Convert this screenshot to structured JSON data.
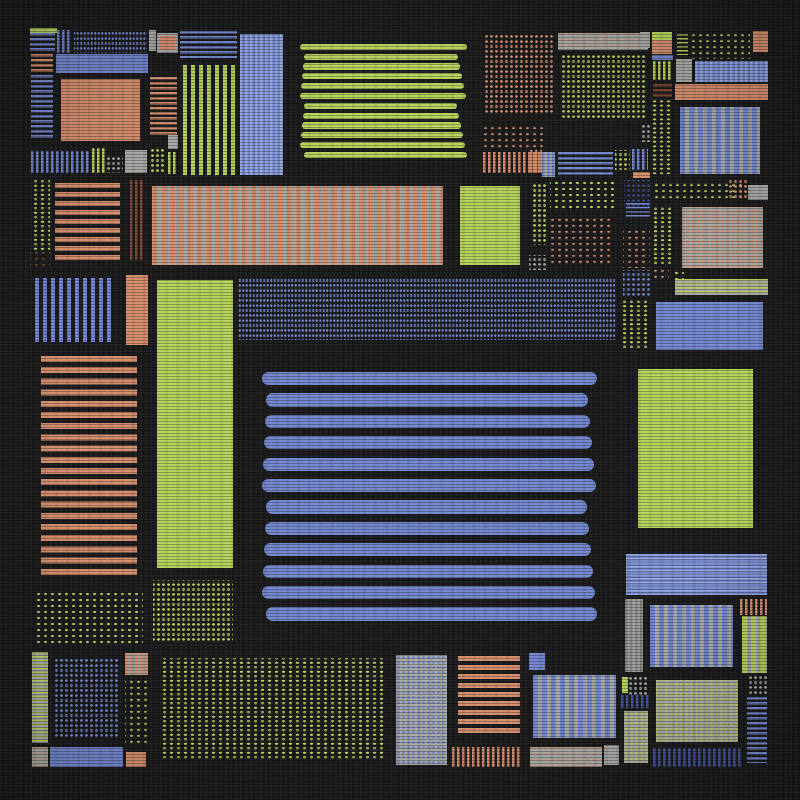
{
  "artwork": {
    "description": "abstract patchwork quilt composition on dark fabric",
    "canvas": {
      "width": 800,
      "height": 800,
      "background": "#1c1c1d"
    }
  },
  "palette": {
    "blue": "#7488d0",
    "blueLight": "#97a7e0",
    "blueDark": "#46559c",
    "navy": "#3d4c88",
    "orange": "#d68e6d",
    "rust": "#7e4531",
    "green": "#b7d35c",
    "gray": "#a9a9a6",
    "grayDark": "#83837f",
    "background": "#1c1c1d"
  },
  "patterns": {
    "solid": {
      "type": "solid"
    },
    "bars": {
      "type": "bars"
    },
    "hs2": {
      "type": "stripes",
      "angle": 180,
      "t": 1.5,
      "per": 4
    },
    "hs3": {
      "type": "stripes",
      "angle": 180,
      "t": 2.5,
      "per": 5
    },
    "hs5": {
      "type": "stripes",
      "angle": 180,
      "t": 5,
      "per": 9
    },
    "hs6": {
      "type": "stripes",
      "angle": 180,
      "t": 6,
      "per": 11.2
    },
    "vs2": {
      "type": "stripes",
      "angle": 90,
      "t": 2.5,
      "per": 5
    },
    "vs4": {
      "type": "stripes",
      "angle": 90,
      "t": 4,
      "per": 8
    },
    "vs5on": {
      "type": "stripes",
      "angle": 90,
      "t": 5,
      "per": 9
    },
    "dots4": {
      "type": "dots",
      "r": 0.9,
      "sx": 3.5,
      "sy": 5
    },
    "dots5": {
      "type": "dots",
      "r": 1.2,
      "sx": 5,
      "sy": 5
    },
    "dots7": {
      "type": "dots",
      "r": 1.2,
      "sx": 7,
      "sy": 6
    },
    "dcol": {
      "type": "dots",
      "r": 1.5,
      "sx": 7,
      "sy": 4.5
    }
  },
  "rects": [
    {
      "x": 30,
      "y": 28,
      "w": 27,
      "h": 5,
      "c": "green",
      "p": "solid"
    },
    {
      "x": 30,
      "y": 33,
      "w": 25,
      "h": 20,
      "c": "blue",
      "p": "hs3"
    },
    {
      "x": 57,
      "y": 30,
      "w": 15,
      "h": 23,
      "c": "blue",
      "p": "vs2"
    },
    {
      "x": 74,
      "y": 30,
      "w": 73,
      "h": 23,
      "c": "blue",
      "p": "dots4"
    },
    {
      "x": 149,
      "y": 30,
      "w": 7,
      "h": 21,
      "c": "gray",
      "p": "solid"
    },
    {
      "x": 157,
      "y": 33,
      "w": 21,
      "h": 20,
      "c": "gray",
      "p": "solid"
    },
    {
      "x": 160,
      "y": 36,
      "w": 15,
      "h": 14,
      "c": "orange",
      "p": "solid"
    },
    {
      "x": 31,
      "y": 54,
      "w": 22,
      "h": 18,
      "c": "orange",
      "p": "hs3"
    },
    {
      "x": 56,
      "y": 54,
      "w": 92,
      "h": 19,
      "c": "blue",
      "p": "solid"
    },
    {
      "x": 180,
      "y": 31,
      "w": 57,
      "h": 27,
      "c": "blue",
      "p": "hs3"
    },
    {
      "x": 240,
      "y": 34,
      "w": 43,
      "h": 141,
      "c": "blueLight",
      "b": "blue",
      "p": "vs2"
    },
    {
      "x": 31,
      "y": 75,
      "w": 22,
      "h": 65,
      "c": "blue",
      "p": "hs3"
    },
    {
      "x": 61,
      "y": 79,
      "w": 79,
      "h": 62,
      "c": "orange",
      "p": "solid"
    },
    {
      "x": 150,
      "y": 77,
      "w": 27,
      "h": 58,
      "c": "orange",
      "p": "hs3"
    },
    {
      "x": 183,
      "y": 65,
      "w": 52,
      "h": 110,
      "c": "green",
      "p": "vs4"
    },
    {
      "x": 168,
      "y": 135,
      "w": 10,
      "h": 14,
      "c": "gray",
      "p": "solid"
    },
    {
      "x": 31,
      "y": 151,
      "w": 59,
      "h": 22,
      "c": "blue",
      "p": "vs2"
    },
    {
      "x": 92,
      "y": 148,
      "w": 13,
      "h": 25,
      "c": "green",
      "p": "vs2"
    },
    {
      "x": 107,
      "y": 155,
      "w": 16,
      "h": 18,
      "c": "gray",
      "p": "dots5"
    },
    {
      "x": 125,
      "y": 150,
      "w": 22,
      "h": 23,
      "c": "gray",
      "p": "solid"
    },
    {
      "x": 150,
      "y": 148,
      "w": 15,
      "h": 25,
      "c": "green",
      "p": "dots5"
    },
    {
      "x": 168,
      "y": 152,
      "w": 10,
      "h": 22,
      "c": "green",
      "p": "vs2"
    },
    {
      "x": 300,
      "y": 42,
      "w": 168,
      "h": 118,
      "c": "green",
      "p": "bars",
      "n": 12
    },
    {
      "x": 485,
      "y": 33,
      "w": 70,
      "h": 82,
      "c": "orange",
      "p": "dots5"
    },
    {
      "x": 480,
      "y": 125,
      "w": 65,
      "h": 24,
      "c": "orange",
      "p": "dots7"
    },
    {
      "x": 483,
      "y": 152,
      "w": 57,
      "h": 21,
      "c": "orange",
      "p": "vs2"
    },
    {
      "x": 558,
      "y": 33,
      "w": 90,
      "h": 17,
      "c": "orange",
      "b": "gray",
      "p": "dots7"
    },
    {
      "x": 560,
      "y": 55,
      "w": 85,
      "h": 65,
      "c": "green",
      "p": "dots5"
    },
    {
      "x": 640,
      "y": 32,
      "w": 10,
      "h": 16,
      "c": "gray",
      "p": "solid"
    },
    {
      "x": 652,
      "y": 32,
      "w": 20,
      "h": 8,
      "c": "green",
      "p": "solid"
    },
    {
      "x": 652,
      "y": 40,
      "w": 20,
      "h": 14,
      "c": "orange",
      "p": "solid"
    },
    {
      "x": 652,
      "y": 55,
      "w": 21,
      "h": 5,
      "c": "blue",
      "p": "solid"
    },
    {
      "x": 653,
      "y": 61,
      "w": 19,
      "h": 19,
      "c": "green",
      "p": "vs2"
    },
    {
      "x": 653,
      "y": 84,
      "w": 19,
      "h": 15,
      "c": "rust",
      "p": "hs3"
    },
    {
      "x": 677,
      "y": 34,
      "w": 11,
      "h": 21,
      "c": "green",
      "p": "hs2"
    },
    {
      "x": 690,
      "y": 34,
      "w": 60,
      "h": 25,
      "c": "green",
      "p": "dots7"
    },
    {
      "x": 753,
      "y": 31,
      "w": 15,
      "h": 21,
      "c": "orange",
      "p": "solid"
    },
    {
      "x": 676,
      "y": 59,
      "w": 16,
      "h": 23,
      "c": "gray",
      "p": "solid"
    },
    {
      "x": 695,
      "y": 61,
      "w": 73,
      "h": 21,
      "c": "blueLight",
      "b": "blue",
      "p": "vs2"
    },
    {
      "x": 675,
      "y": 84,
      "w": 93,
      "h": 16,
      "c": "orange",
      "p": "solid"
    },
    {
      "x": 650,
      "y": 100,
      "w": 20,
      "h": 74,
      "c": "green",
      "p": "dcol"
    },
    {
      "x": 680,
      "y": 107,
      "w": 80,
      "h": 67,
      "c": "blue",
      "b": "gray",
      "p": "vs5on"
    },
    {
      "x": 640,
      "y": 125,
      "w": 10,
      "h": 17,
      "c": "gray",
      "p": "dots5"
    },
    {
      "x": 530,
      "y": 150,
      "w": 12,
      "h": 23,
      "c": "orange",
      "p": "vs2"
    },
    {
      "x": 542,
      "y": 152,
      "w": 13,
      "h": 25,
      "c": "blue",
      "b": "gray",
      "p": "vs2"
    },
    {
      "x": 558,
      "y": 152,
      "w": 55,
      "h": 25,
      "c": "blue",
      "p": "hs3"
    },
    {
      "x": 615,
      "y": 150,
      "w": 15,
      "h": 20,
      "c": "green",
      "p": "dots5"
    },
    {
      "x": 632,
      "y": 149,
      "w": 16,
      "h": 21,
      "c": "blue",
      "p": "vs2"
    },
    {
      "x": 633,
      "y": 172,
      "w": 17,
      "h": 6,
      "c": "orange",
      "p": "solid"
    },
    {
      "x": 32,
      "y": 180,
      "w": 18,
      "h": 70,
      "c": "green",
      "p": "dcol"
    },
    {
      "x": 30,
      "y": 252,
      "w": 20,
      "h": 16,
      "c": "rust",
      "p": "dots7"
    },
    {
      "x": 55,
      "y": 183,
      "w": 65,
      "h": 77,
      "c": "orange",
      "p": "hs5"
    },
    {
      "x": 130,
      "y": 180,
      "w": 13,
      "h": 80,
      "c": "rust",
      "p": "vs2"
    },
    {
      "x": 152,
      "y": 186,
      "w": 291,
      "h": 79,
      "c": "orange",
      "b": "gray",
      "p": "vs5on"
    },
    {
      "x": 460,
      "y": 186,
      "w": 60,
      "h": 79,
      "c": "green",
      "p": "solid"
    },
    {
      "x": 532,
      "y": 183,
      "w": 14,
      "h": 62,
      "c": "green",
      "p": "dots5"
    },
    {
      "x": 529,
      "y": 255,
      "w": 17,
      "h": 15,
      "c": "gray",
      "p": "dots5"
    },
    {
      "x": 550,
      "y": 180,
      "w": 65,
      "h": 30,
      "c": "green",
      "p": "dots7"
    },
    {
      "x": 550,
      "y": 215,
      "w": 60,
      "h": 50,
      "c": "orange",
      "p": "dots7"
    },
    {
      "x": 624,
      "y": 180,
      "w": 26,
      "h": 28,
      "c": "navy",
      "p": "dots5"
    },
    {
      "x": 626,
      "y": 203,
      "w": 24,
      "h": 14,
      "c": "blue",
      "p": "hs2"
    },
    {
      "x": 652,
      "y": 180,
      "w": 91,
      "h": 20,
      "c": "green",
      "p": "dots7"
    },
    {
      "x": 727,
      "y": 180,
      "w": 20,
      "h": 20,
      "c": "orange",
      "p": "dots5"
    },
    {
      "x": 748,
      "y": 185,
      "w": 20,
      "h": 15,
      "c": "gray",
      "p": "solid"
    },
    {
      "x": 623,
      "y": 227,
      "w": 27,
      "h": 41,
      "c": "orange",
      "p": "dots7"
    },
    {
      "x": 653,
      "y": 207,
      "w": 20,
      "h": 58,
      "c": "green",
      "p": "dcol"
    },
    {
      "x": 682,
      "y": 207,
      "w": 81,
      "h": 61,
      "c": "orange",
      "b": "gray",
      "p": "dots5"
    },
    {
      "x": 35,
      "y": 278,
      "w": 78,
      "h": 64,
      "c": "blue",
      "p": "vs4"
    },
    {
      "x": 126,
      "y": 275,
      "w": 22,
      "h": 70,
      "c": "orange",
      "p": "solid"
    },
    {
      "x": 157,
      "y": 280,
      "w": 76,
      "h": 288,
      "c": "green",
      "p": "solid"
    },
    {
      "x": 238,
      "y": 278,
      "w": 377,
      "h": 62,
      "c": "blue",
      "p": "dots4"
    },
    {
      "x": 623,
      "y": 270,
      "w": 27,
      "h": 28,
      "c": "blue",
      "p": "dots5"
    },
    {
      "x": 653,
      "y": 268,
      "w": 16,
      "h": 12,
      "c": "orange",
      "p": "dots7"
    },
    {
      "x": 671,
      "y": 268,
      "w": 13,
      "h": 12,
      "c": "green",
      "p": "dots7"
    },
    {
      "x": 623,
      "y": 300,
      "w": 27,
      "h": 50,
      "c": "green",
      "p": "dcol"
    },
    {
      "x": 675,
      "y": 279,
      "w": 93,
      "h": 16,
      "c": "green",
      "b": "gray",
      "p": "hs2"
    },
    {
      "x": 656,
      "y": 302,
      "w": 107,
      "h": 48,
      "c": "blue",
      "p": "solid"
    },
    {
      "x": 41,
      "y": 356,
      "w": 96,
      "h": 224,
      "c": "orange",
      "p": "hs6"
    },
    {
      "x": 262,
      "y": 368,
      "w": 336,
      "h": 257,
      "c": "blue",
      "p": "bars",
      "n": 12
    },
    {
      "x": 638,
      "y": 369,
      "w": 115,
      "h": 159,
      "c": "green",
      "p": "solid"
    },
    {
      "x": 33,
      "y": 593,
      "w": 110,
      "h": 52,
      "c": "green",
      "p": "dots7"
    },
    {
      "x": 153,
      "y": 580,
      "w": 80,
      "h": 63,
      "c": "green",
      "p": "dots5"
    },
    {
      "x": 32,
      "y": 652,
      "w": 16,
      "h": 91,
      "c": "green",
      "b": "gray",
      "p": "hs2"
    },
    {
      "x": 55,
      "y": 657,
      "w": 63,
      "h": 80,
      "c": "blue",
      "p": "dots5"
    },
    {
      "x": 125,
      "y": 653,
      "w": 23,
      "h": 22,
      "c": "orange",
      "b": "gray",
      "p": "vs2"
    },
    {
      "x": 125,
      "y": 677,
      "w": 23,
      "h": 66,
      "c": "green",
      "p": "dots7"
    },
    {
      "x": 32,
      "y": 747,
      "w": 16,
      "h": 20,
      "c": "orange",
      "b": "gray",
      "p": "dots7"
    },
    {
      "x": 50,
      "y": 747,
      "w": 73,
      "h": 20,
      "c": "blue",
      "p": "solid"
    },
    {
      "x": 126,
      "y": 752,
      "w": 20,
      "h": 15,
      "c": "orange",
      "p": "solid"
    },
    {
      "x": 160,
      "y": 658,
      "w": 225,
      "h": 102,
      "c": "green",
      "p": "dcol"
    },
    {
      "x": 396,
      "y": 655,
      "w": 51,
      "h": 110,
      "c": "blue",
      "b": "gray",
      "p": "dots5"
    },
    {
      "x": 458,
      "y": 656,
      "w": 62,
      "h": 78,
      "c": "orange",
      "p": "hs5"
    },
    {
      "x": 452,
      "y": 747,
      "w": 68,
      "h": 20,
      "c": "orange",
      "p": "vs2"
    },
    {
      "x": 529,
      "y": 653,
      "w": 16,
      "h": 17,
      "c": "blue",
      "p": "solid"
    },
    {
      "x": 533,
      "y": 675,
      "w": 83,
      "h": 63,
      "c": "blue",
      "b": "gray",
      "p": "vs5on"
    },
    {
      "x": 530,
      "y": 747,
      "w": 72,
      "h": 20,
      "c": "orange",
      "b": "gray",
      "p": "dots7"
    },
    {
      "x": 604,
      "y": 745,
      "w": 15,
      "h": 20,
      "c": "gray",
      "p": "solid"
    },
    {
      "x": 626,
      "y": 554,
      "w": 141,
      "h": 41,
      "c": "blueLight",
      "b": "blue",
      "p": "hs2"
    },
    {
      "x": 625,
      "y": 599,
      "w": 18,
      "h": 73,
      "c": "grayDark",
      "b": "gray",
      "p": "vs2"
    },
    {
      "x": 650,
      "y": 605,
      "w": 83,
      "h": 62,
      "c": "blue",
      "b": "gray",
      "p": "vs5on"
    },
    {
      "x": 740,
      "y": 599,
      "w": 27,
      "h": 16,
      "c": "orange",
      "p": "vs2"
    },
    {
      "x": 742,
      "y": 616,
      "w": 25,
      "h": 57,
      "c": "green",
      "b": "gray",
      "p": "vs5on"
    },
    {
      "x": 622,
      "y": 677,
      "w": 6,
      "h": 16,
      "c": "green",
      "p": "solid"
    },
    {
      "x": 629,
      "y": 675,
      "w": 20,
      "h": 20,
      "c": "gray",
      "p": "dots5"
    },
    {
      "x": 621,
      "y": 695,
      "w": 29,
      "h": 13,
      "c": "blueDark",
      "p": "vs2"
    },
    {
      "x": 624,
      "y": 711,
      "w": 24,
      "h": 52,
      "c": "green",
      "b": "gray",
      "p": "dots5"
    },
    {
      "x": 656,
      "y": 680,
      "w": 82,
      "h": 62,
      "c": "green",
      "b": "gray",
      "p": "dots5"
    },
    {
      "x": 747,
      "y": 676,
      "w": 20,
      "h": 18,
      "c": "gray",
      "p": "dots5"
    },
    {
      "x": 747,
      "y": 697,
      "w": 20,
      "h": 66,
      "c": "blue",
      "p": "hs3"
    },
    {
      "x": 653,
      "y": 748,
      "w": 89,
      "h": 19,
      "c": "blueDark",
      "p": "vs2"
    }
  ]
}
